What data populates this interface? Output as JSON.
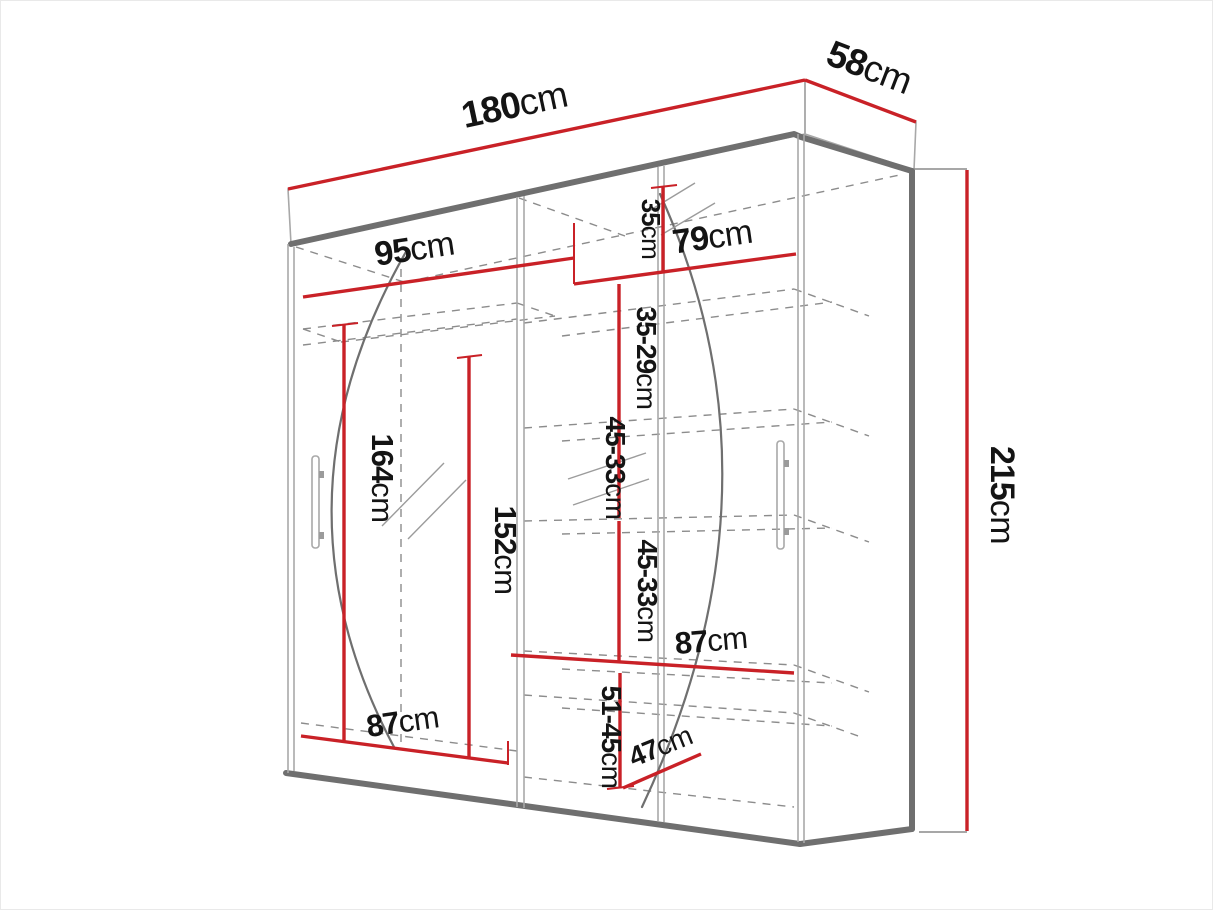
{
  "diagram": {
    "type": "wardrobe-dimension-drawing",
    "unit": "cm",
    "style": "perspective line drawing, red dimension lines, dashed interior shelves"
  },
  "colors": {
    "dimension": "#c92127",
    "structure": "#6f6f6f",
    "light": "#a8a8a8",
    "dash": "#8c8c8c",
    "ink": "#141414",
    "background": "#ffffff"
  },
  "labels": {
    "width_total": {
      "num": "180",
      "unit": "cm",
      "value": 180
    },
    "depth_total": {
      "num": "58",
      "unit": "cm",
      "value": 58
    },
    "height_total": {
      "num": "215",
      "unit": "cm",
      "value": 215
    },
    "left_top_width": {
      "num": "95",
      "unit": "cm",
      "value": 95
    },
    "right_top_width": {
      "num": "79",
      "unit": "cm",
      "value": 79
    },
    "right_top_shelf_height": {
      "num": "35",
      "unit": "cm",
      "value": 35
    },
    "right_upper_shelf_height": {
      "num": "35-29",
      "unit": "cm"
    },
    "right_middle_shelf_height_a": {
      "num": "45-33",
      "unit": "cm"
    },
    "right_middle_shelf_height_b": {
      "num": "45-33",
      "unit": "cm"
    },
    "left_hanging_height": {
      "num": "164",
      "unit": "cm",
      "value": 164
    },
    "center_hanging_height": {
      "num": "152",
      "unit": "cm",
      "value": 152
    },
    "right_bottom_width": {
      "num": "87",
      "unit": "cm",
      "value": 87
    },
    "left_bottom_width": {
      "num": "87",
      "unit": "cm",
      "value": 87
    },
    "bottom_compartment_height": {
      "num": "51-45",
      "unit": "cm"
    },
    "bottom_shelf_depth": {
      "num": "47",
      "unit": "cm",
      "value": 47
    }
  }
}
